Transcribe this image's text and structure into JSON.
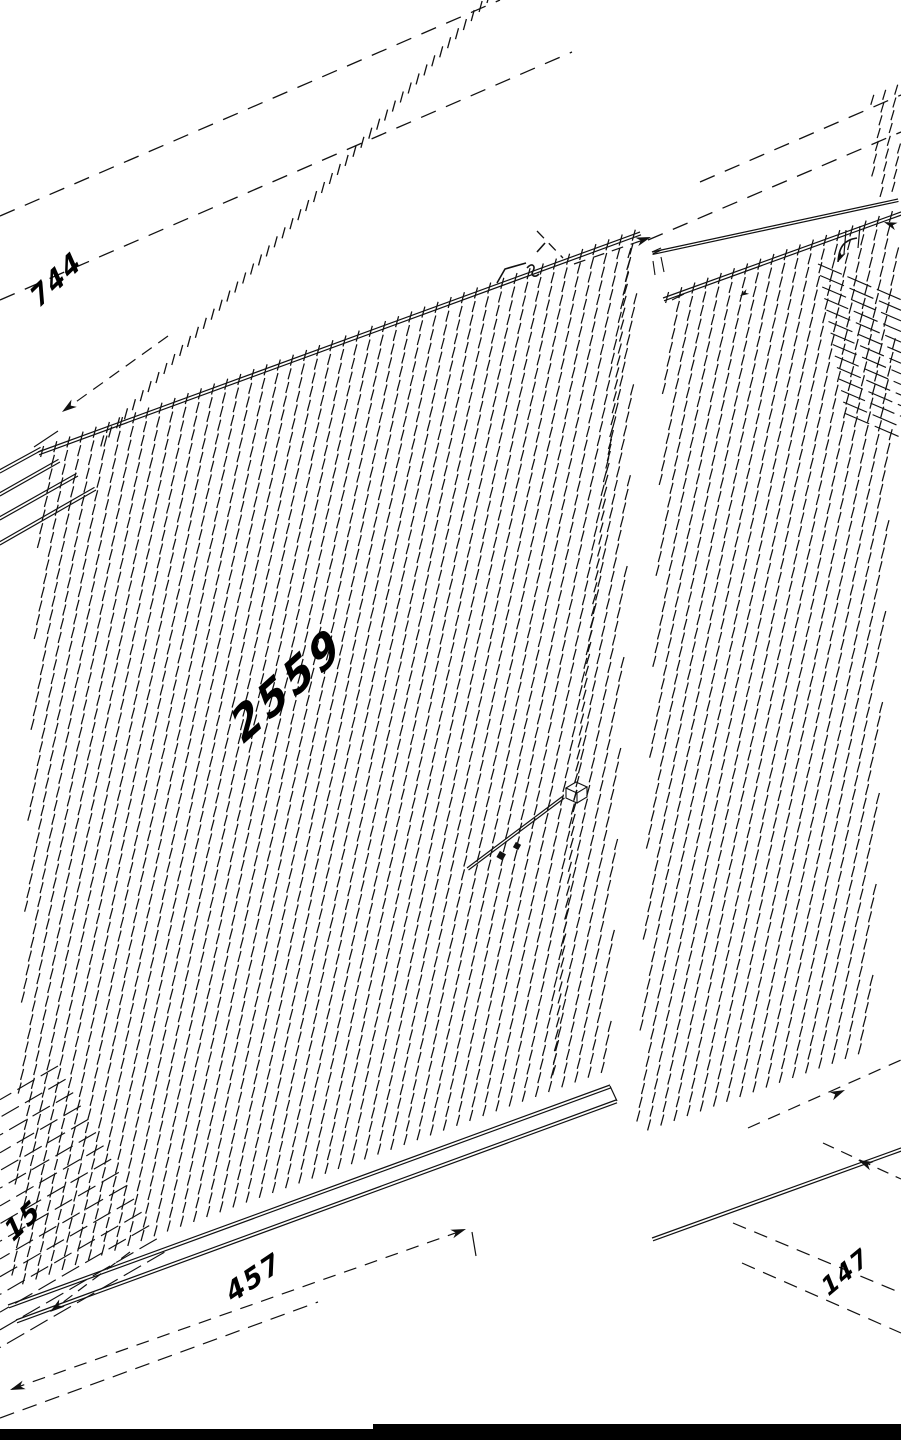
{
  "dimensions": {
    "length": "2559",
    "top_left": "744",
    "bottom_left": "15",
    "bottom_center": "457",
    "bottom_right": "147"
  },
  "colors": {
    "line": "#111111",
    "background": "#ffffff",
    "footer_bar": "#000000"
  }
}
